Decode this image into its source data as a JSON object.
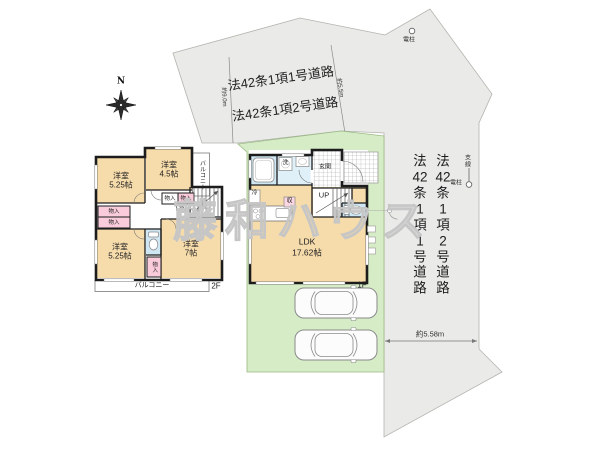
{
  "compass": {
    "north": "N"
  },
  "roads": {
    "top_line1": "法42条1項1号道路",
    "top_line2": "法42条1項2号道路",
    "right_column_1": "法\n42\n条\n1\n項\n1\n号\n道\n路",
    "right_column_2": "法\n42\n条\n1\n項\n2\n号\n道\n路"
  },
  "measurements": {
    "frontage_left": "約9.0m",
    "frontage_right": "約5.5m",
    "east_width": "約5.58m"
  },
  "utility": {
    "pole_top": "電柱",
    "pole_right": "電柱",
    "support_wire": "支線"
  },
  "watermark": "藤和ハウス",
  "colors": {
    "room_fill": "#f6dbab",
    "closet_fill": "#f9cbdb",
    "wet_area_fill": "#cfe7f3",
    "site_green": "#d6ecc6",
    "road_gray": "#eaeae8"
  },
  "floor2": {
    "floor_label": "2F",
    "room_nw": "洋室\n5.25帖",
    "room_n": "洋室\n4.5帖",
    "room_sw": "洋室\n5.25帖",
    "room_se": "洋室\n7帖",
    "balcony_east": "バルコニー",
    "balcony_south": "バルコニー",
    "stairs_down": "DN",
    "closet_n1": "物入",
    "closet_n2": "物入",
    "closet_w1": "物入",
    "closet_w2": "物入",
    "closet_s": "物入"
  },
  "floor1": {
    "floor_label": "1F",
    "entrance": "玄関",
    "stairs_up": "UP",
    "living": "LDK\n17.62帖",
    "refrigerator": "冷",
    "storage": "収",
    "laundry": "洗"
  }
}
